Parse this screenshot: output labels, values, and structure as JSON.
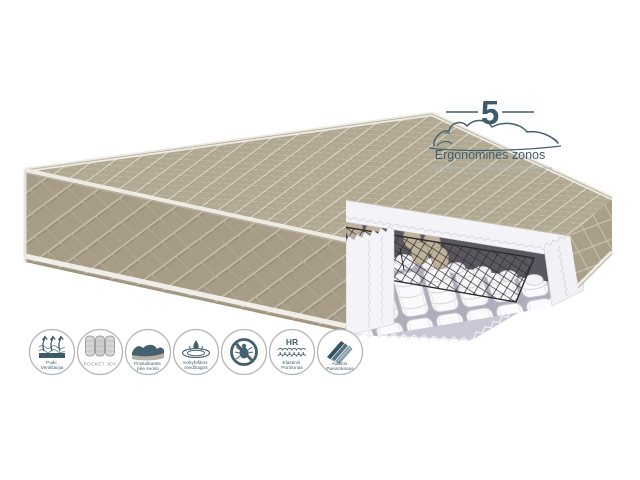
{
  "badge": {
    "number": "5",
    "label": "Ergonominės zonos"
  },
  "features": [
    {
      "name": "ventilation",
      "lines": [
        "Puiki",
        "Ventiliacija"
      ]
    },
    {
      "name": "pocket-joy",
      "lines": [
        "POCKET JOY"
      ]
    },
    {
      "name": "adapts-to-weight",
      "lines": [
        "Prisitaikantis",
        "prie svorio"
      ]
    },
    {
      "name": "quality-materials",
      "lines": [
        "Kokybiškos",
        "medžiagos"
      ]
    },
    {
      "name": "anti-dust-mite",
      "lines": []
    },
    {
      "name": "hr-foam",
      "glyph_text": "HR",
      "lines": [
        "Elastinis",
        "Porolonas"
      ]
    },
    {
      "name": "fabric-choice",
      "lines": [
        "Audinio",
        "Pasirinkimas"
      ]
    }
  ],
  "colors": {
    "accent_slate": "#3f5d6c",
    "fabric_beige_top": "#b2a993",
    "fabric_beige_side": "#a79c86",
    "foam_white": "#f4f3f7",
    "felt_gray": "#5a5760",
    "base_gray": "#cac7d4",
    "icon_gray": "#8e8e8e"
  }
}
